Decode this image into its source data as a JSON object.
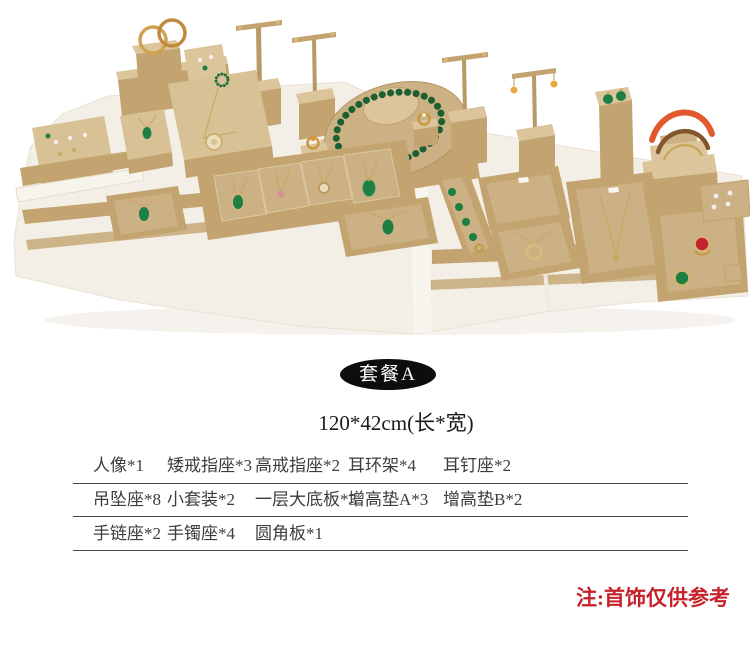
{
  "photo": {
    "colors": {
      "prop_tan": "#c3a470",
      "prop_tan_light": "#dcc59b",
      "suede_pad": "#cbb183",
      "platform_white": "#f4efe6",
      "jade_green": "#1e7f44",
      "gold": "#c9973f",
      "gem_red": "#c52331",
      "bangle_orange": "#e0592f",
      "earring_yellow": "#e6a93c"
    }
  },
  "badge": {
    "label": "套餐A",
    "background": "#0d0d0d",
    "text_color": "#ffffff"
  },
  "size_line": {
    "text": "120*42cm(长*宽)"
  },
  "items_table": {
    "rows": [
      {
        "cells": [
          "人像*1",
          "矮戒指座*3",
          "高戒指座*2",
          "耳环架*4",
          "耳钉座*2"
        ]
      },
      {
        "cells": [
          "吊坠座*8",
          "小套装*2",
          "一层大底板*3",
          "增高垫A*3",
          "增高垫B*2"
        ]
      },
      {
        "cells": [
          "手链座*2",
          "手镯座*4",
          "圆角板*1"
        ]
      }
    ]
  },
  "note": {
    "text": "注:首饰仅供参考",
    "color": "#c5232c"
  }
}
